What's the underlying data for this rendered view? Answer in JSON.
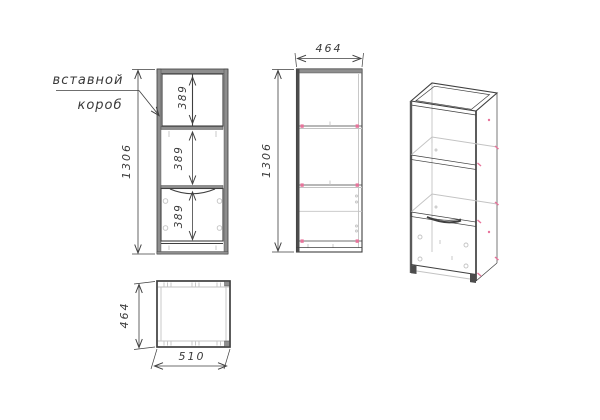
{
  "colors": {
    "line": "#3f3f3f",
    "panel": "#8e8e8e",
    "light": "#c3c3c3",
    "marker": "#e8739b",
    "hatch": "#a6a6a6",
    "text": "#3a3a3a"
  },
  "callout": {
    "line1": "вставной",
    "line2": "короб"
  },
  "views": {
    "front": {
      "height": "1306",
      "insert_box_height": "389",
      "middle_section_height": "389",
      "lower_section_height": "389"
    },
    "side": {
      "depth": "464",
      "height": "1306"
    },
    "plan": {
      "depth": "464",
      "width": "510"
    }
  }
}
